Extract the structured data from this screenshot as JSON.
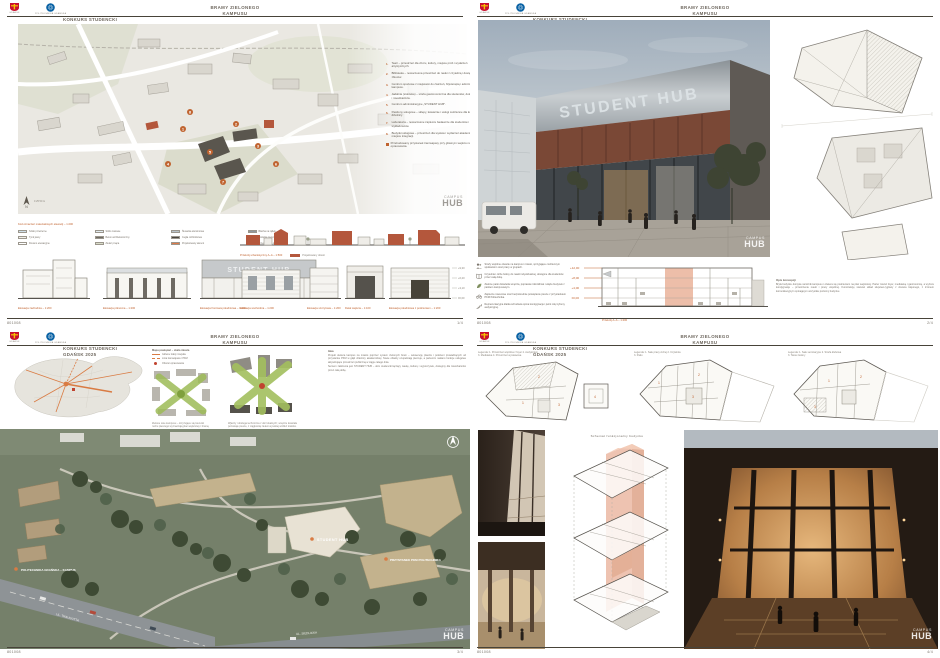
{
  "meta": {
    "entry_code": "801008",
    "accent": "#c0632f"
  },
  "watermark": {
    "line1": "CAMPUS",
    "line2": "HUB"
  },
  "header": {
    "competition_line1": "KONKURS STUDENCKI",
    "competition_line2": "GDAŃSK 2025",
    "title_line1": "BRAMY  ZIELONEGO",
    "title_line2": "KAMPUSU",
    "logo_city": "GDAŃSK",
    "logo_university": "POLITECHNIKA GDAŃSKA"
  },
  "board1": {
    "page": "1/4",
    "sign": "STUDENT HUB",
    "program": [
      {
        "num": "1.",
        "text": "Teatr – przestrzeń dla chóru, kultury, miejsce prób i wydarzeń artystycznych."
      },
      {
        "num": "2.",
        "text": "Biblioteka – nowoczesna przestrzeń do nauki z czytelnią i dostępem do zbiorów."
      },
      {
        "num": "3.",
        "text": "Centrum sportowe z miejscami do ćwiczeń, fizjoterapią i administracją kampusu."
      },
      {
        "num": "4.",
        "text": "Jadalnia (stołówka) – strefa gastronomiczna dla studentów, doktorantów i mieszkańców."
      },
      {
        "num": "5.",
        "text": "Centrum administracyjne „STUDENT HUB”."
      },
      {
        "num": "6.",
        "text": "Pawilony usługowe – sklepy, kawiarnie i usługi codzienne dla kampusu i dzielnicy."
      },
      {
        "num": "7.",
        "text": "Laboratoria – nowoczesne zaplecze badawcze dla studentów i wykładowców."
      },
      {
        "num": "8.",
        "text": "Budynki usługowe – przestrzeń dla wystaw i wydarzeń akademickich, miejsce integracji."
      }
    ],
    "program_extra": "Przebudowany przystanek tramwajowy przy głównym wejściu na teren opracowania.",
    "scalebar": "0    25    50 m",
    "legend_title": "Kod oznaczeń materiałowych elewacji – 1:200",
    "legend": [
      {
        "c": "#cfe0ea",
        "t": "Szkło przezierne"
      },
      {
        "c": "#e2ebf1",
        "t": "Szkło matowe"
      },
      {
        "c": "#b9c3c9",
        "t": "Ślusarka aluminiowa"
      },
      {
        "c": "#8f989e",
        "t": "Blacha na rąbek"
      },
      {
        "c": "#f1efe9",
        "t": "Tynk jasny"
      },
      {
        "c": "#6e6a63",
        "t": "Beton architektoniczny"
      },
      {
        "c": "#4a463f",
        "t": "Cegła rozbiórkowa"
      },
      {
        "c": "#2e2b26",
        "t": "Stolarka ciemna"
      },
      {
        "c": "#ffffff",
        "t": "Drewno elewacyjne"
      },
      {
        "c": "#d8dcc8",
        "t": "Zieleń pnąca"
      },
      {
        "c": "#de7a4a",
        "t": "Projektowany akcent"
      },
      {
        "c": "#ffffff",
        "t": "Przeszklenie otwierane"
      }
    ],
    "elev_left": [
      "Elewacja zachodnia – 1:200",
      "Elewacja północna – 1:200",
      "Elewacja frontowa południowa – 1:200"
    ],
    "section_caption": "Przekrój urbanistyczny A–A  –  1:500",
    "section_chip": "Projektowany obiekt",
    "elev_right": [
      "Elewacja wschodnia – 1:200",
      "Elewacja szczytowa – 1:200",
      "Detal wejścia – 1:100",
      "Elewacja południowa z podcieniem – 1:200"
    ],
    "levels": [
      "+9,30",
      "+6,20",
      "+3,10",
      "±0,00"
    ]
  },
  "board2": {
    "page": "2/4",
    "sign": "STUDENT HUB",
    "annotations": [
      {
        "icon": "users-icon",
        "text": "Strefy wspólne otwarte na kampus i miasto, sprzyjające codziennym spotkaniom oraz pracy w grupach."
      },
      {
        "icon": "book-icon",
        "text": "Czytelnia i ciche boksy do nauki indywidualnej, dostępne dla studentów przez całą dobę."
      },
      {
        "icon": "leaf-icon",
        "text": "Zielone patio doświetla wnętrza, poprawia mikroklimat i wiąże budynek z parkiem kampusowym."
      },
      {
        "icon": "bike-icon",
        "text": "Zaplecze rowerowe oraz bezpośrednie powiązanie piesze z przystankiem PKM Politechnika."
      },
      {
        "icon": "stairs-icon",
        "text": "Reprezentacyjna klatka schodowa spina kondygnacje i pełni rolę trybuny audytoryjnej."
      }
    ],
    "section_caption": "Przekrój A–A  –  1:200",
    "section_levels": [
      "+12,00",
      "+8,00",
      "+4,00",
      "±0,00"
    ],
    "description_title": "Opis koncepcji",
    "description_body": "Bryła budynku domyka narożnik kampusu i otwiera się podcieniem na plac wejściowy. Parter mieści foyer, mediatekę i gastronomię, a wyższe kondygnacje – przestrzenie nauki i pracy wspólnej. Konstrukcję stanowi układ słupowo-ryglowy z drewna klejonego, z trzonem komunikacyjnym spinającym wszystkie poziomy budynku."
  },
  "board3": {
    "page": "3/4",
    "map_legend_title": "Mapa powiązań – skala miasta",
    "map_legend": [
      {
        "t": "Główne trakty miejskie"
      },
      {
        "t": "Linia tramwajowa / PKM"
      },
      {
        "t": "Obszar opracowania"
      }
    ],
    "diagram_a_caption": "Zielone osie kampusu – krzyżujące się kierunki ruchu pieszego wyznaczają plac wejściowy i bramę dzielnicy akademickiej.",
    "diagram_b_caption": "Wjazdy i obsługa techniczna z ulic lokalnych; wnętrze kwartału pozostaje piesze, z ciągłością zieleni wysokiej wzdłuż traktów.",
    "idea_title": "Idea",
    "idea_p1": "Projekt otwiera kampus na miasto poprzez system zielonych bram – sekwencję placów i podcieni prowadzących od przystanku PKM w głąb dzielnicy akademickiej. Nowe obiekty uzupełniają pierzeje, a parterom nadano funkcje usługowe aktywizujące przestrzeń publiczną w ciągu całego dnia.",
    "idea_p2": "Sercem założenia jest STUDENT HUB – dom studencki łączący naukę, kulturę i wypoczynek, dostępny dla mieszkańców przez całą dobę.",
    "aerial_labels": [
      {
        "text": "STUDENT HUB"
      },
      {
        "text": "PRZYSTANEK PKM POLITECHNIKA"
      },
      {
        "text": "POLITECHNIKA GDAŃSKA – KAMPUS"
      }
    ],
    "road_labels": [
      "UL. TRAUGUTTA",
      "UL. SIEDLICKA"
    ]
  },
  "board4": {
    "page": "4/4",
    "plans": [
      {
        "legend1": "Legenda:  1. Przestrzeń wspólna z foyer   2. Audytorium",
        "legend2": "3. Mediateka   4. Przestrzeń wystawowa",
        "caption": "Rzut parteru  –  1:250"
      },
      {
        "legend1": "Legenda:  1. Sale pracy cichej   2. Czytelnia",
        "legend2": "3. Patio",
        "caption": "Rzut piętra +1  –  1:250"
      },
      {
        "legend1": "Legenda:  1. Sale seminaryjne   2. Strefa klubowa",
        "legend2": "3. Taras zielony",
        "caption": "Rzut piętra +2  –  1:250"
      }
    ],
    "axo_title": "Schemat  funkcjonalny  budynku"
  }
}
